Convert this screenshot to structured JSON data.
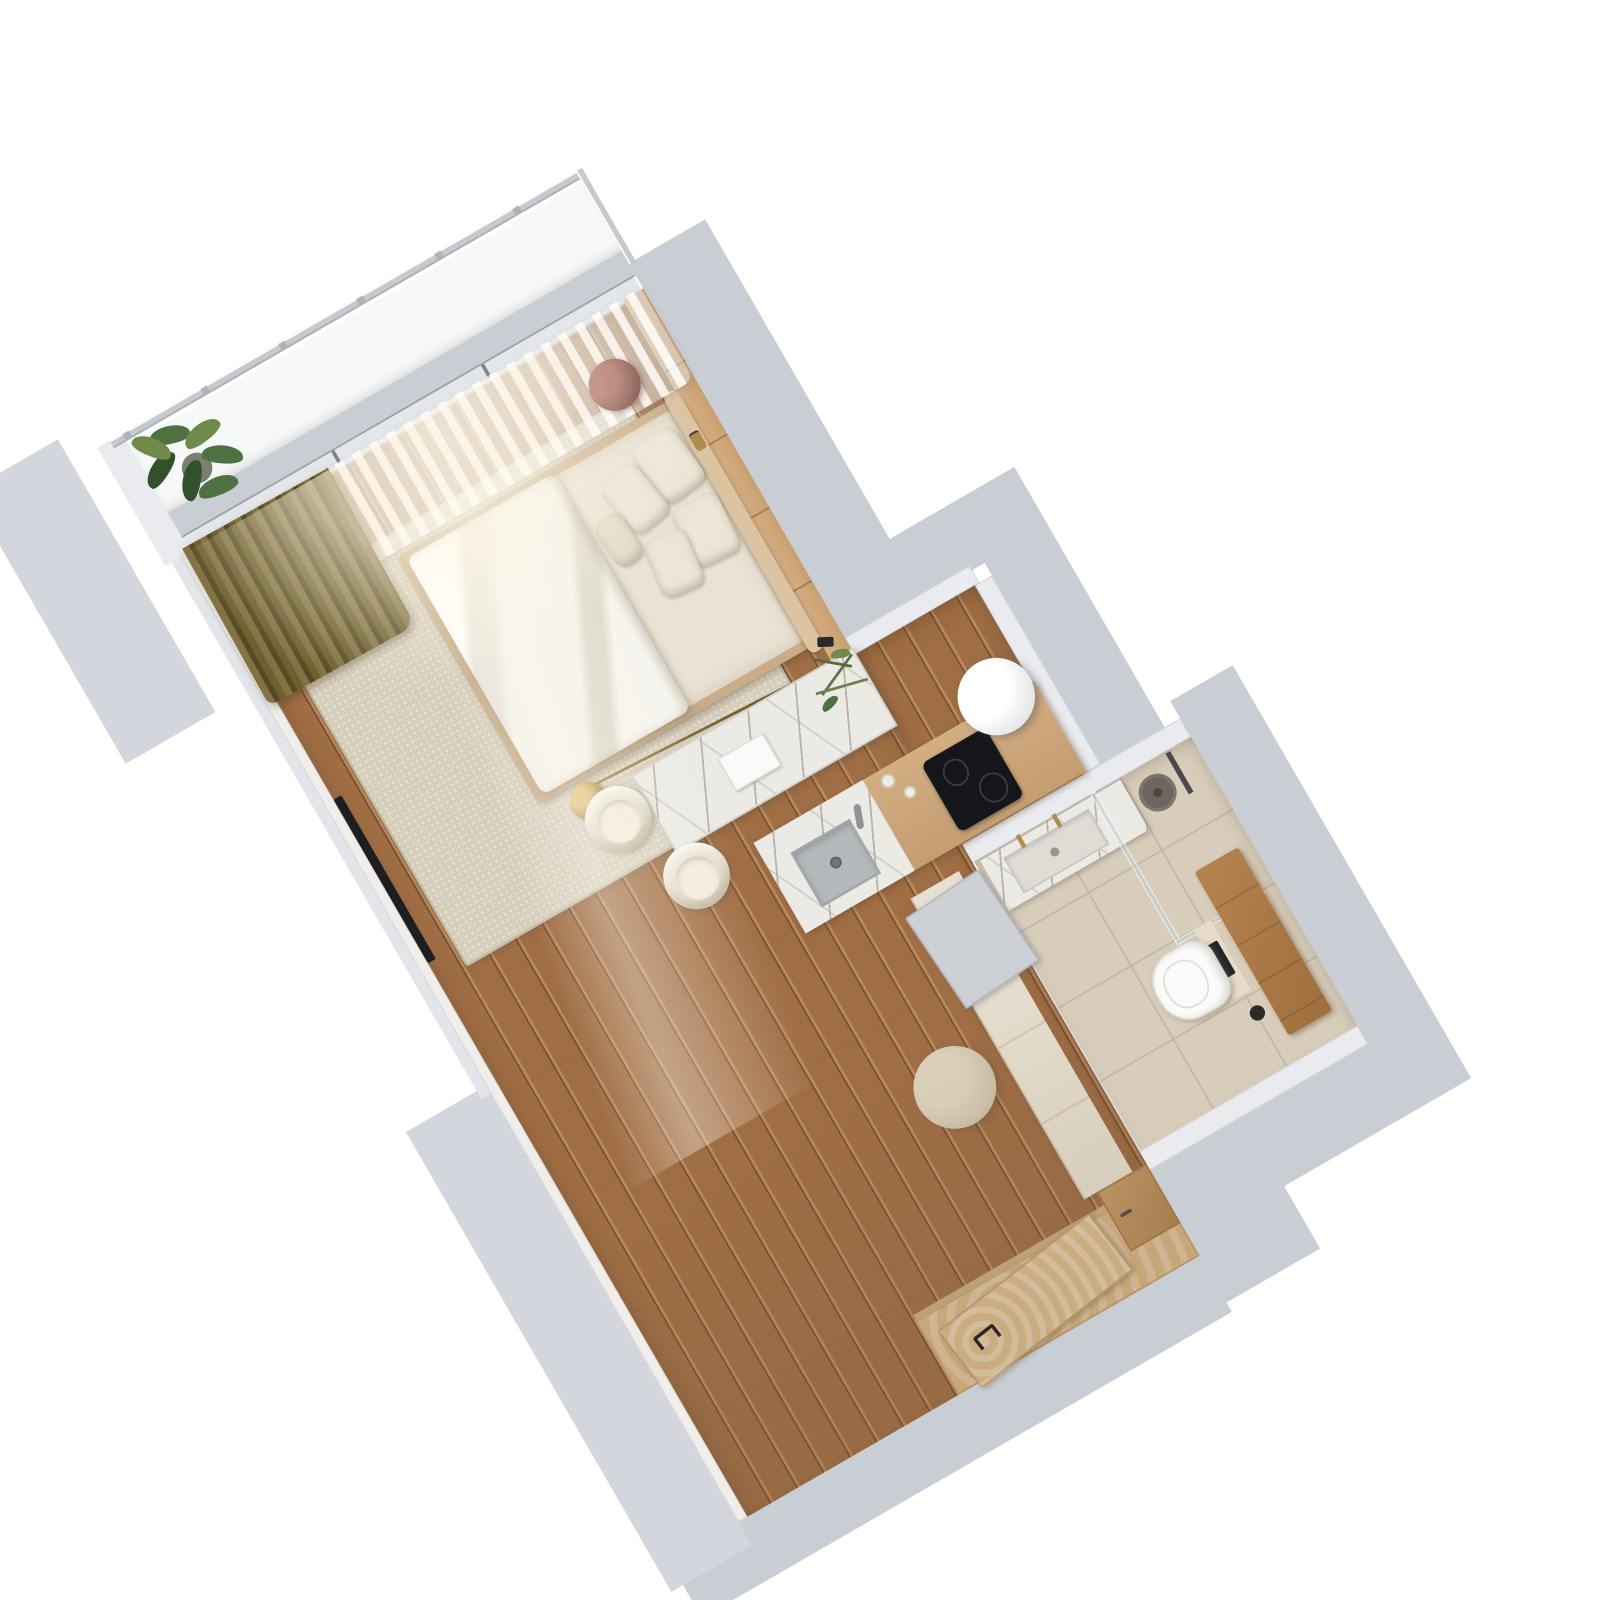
{
  "scene": {
    "kind": "3d-top-down-floorplan-render",
    "subject": "studio apartment with balcony, bedroom-living area, kitchenette, bathroom and entry hall",
    "rotation_degrees": -30,
    "background": "#ffffff"
  },
  "palette": {
    "wallGray": "#c9cdd4",
    "wallGrayLight": "#d3d6dc",
    "wallCap": "#e9ebef",
    "balconyFloor": "#f7f8f8",
    "railing": "#c6cacf",
    "wood": "#a06e45",
    "woodDark": "#7d5130",
    "woodLight": "#b98a5d",
    "panelWood": "#d8b286",
    "rug": "#d6cfbc",
    "duvet": "#f4f2ec",
    "linen": "#e9e3d5",
    "pillow": "#ece6d7",
    "headboard": "#dcc3a2",
    "bedFrame": "#c9ad89",
    "olive": "#847244",
    "oliveDark": "#574b26",
    "marble": "#eceae5",
    "marbleVein": "#b9b3ab",
    "counterWood": "#d2ae83",
    "sinkGray": "#b3b8bb",
    "cooktop": "#14161a",
    "cylinder": "#ffffff",
    "tile": "#d8cdba",
    "tileLine": "#c3b8a3",
    "bench": "#b5834f",
    "toilet": "#fbfbf9",
    "cream": "#e9e2d1",
    "creamLight": "#f2ecdd",
    "cabinetCream": "#e7dfcf",
    "doorGray": "#cdd1d6",
    "pouf": "#cfc3ab",
    "entryWood": "#dcbc8e",
    "plant": "#4f7040",
    "plantDark": "#31502b",
    "plantLight": "#6f8a4a",
    "brass": "#b08d4f",
    "tv": "#1d1e20",
    "sideTable": "#7b4a44"
  },
  "rooms": {
    "balcony": {
      "name": "balcony",
      "items": [
        "glass and metal railing",
        "railing posts",
        "potted green plant",
        "white balcony floor"
      ]
    },
    "bedroom": {
      "name": "bedroom / living area",
      "items": [
        "double bed with white duvet",
        "beige linen mattress",
        "5 pillows",
        "upholstered headboard",
        "wood panel headboard wall",
        "sheer white curtains",
        "olive blackout curtain",
        "round burgundy side table",
        "wall lamp",
        "arc floor lamp with brass sphere",
        "beige area rug",
        "wall-mounted tv",
        "oak plank floor"
      ]
    },
    "dining": {
      "name": "dining corner",
      "items": [
        "marble dining table",
        "2 cream boucle chairs",
        "open book",
        "olive branch sprigs"
      ]
    },
    "kitchen": {
      "name": "kitchenette niche",
      "items": [
        "counter with wood and marble top",
        "gray undermount sink with drain",
        "faucet",
        "black induction cooktop",
        "white cylindrical column",
        "2 small bottles"
      ]
    },
    "bathroom": {
      "name": "bathroom",
      "items": [
        "marble vanity with sink and gold faucets",
        "walk-in shower with glass partition",
        "round rain shower head",
        "shower column",
        "wood bench",
        "wall-hung toilet",
        "black flush plate",
        "toilet brush",
        "beige large-format tile floor",
        "gray door leaf opened into hall"
      ]
    },
    "hallway": {
      "name": "entry hallway",
      "items": [
        "cream storage cabinet",
        "wood lower cabinet with handle",
        "round beige pouf",
        "entry door in light wood with black handle",
        "plywood entry mat area",
        "threshold strip"
      ]
    },
    "exterior": {
      "name": "exterior",
      "items": [
        "thick light-gray structural walls",
        "neighboring wall slab at top-left",
        "white background"
      ]
    }
  },
  "counts": {
    "pillows": 5,
    "chairs": 2,
    "railing_posts": 6,
    "bottles": 2,
    "gold_faucets": 2
  }
}
